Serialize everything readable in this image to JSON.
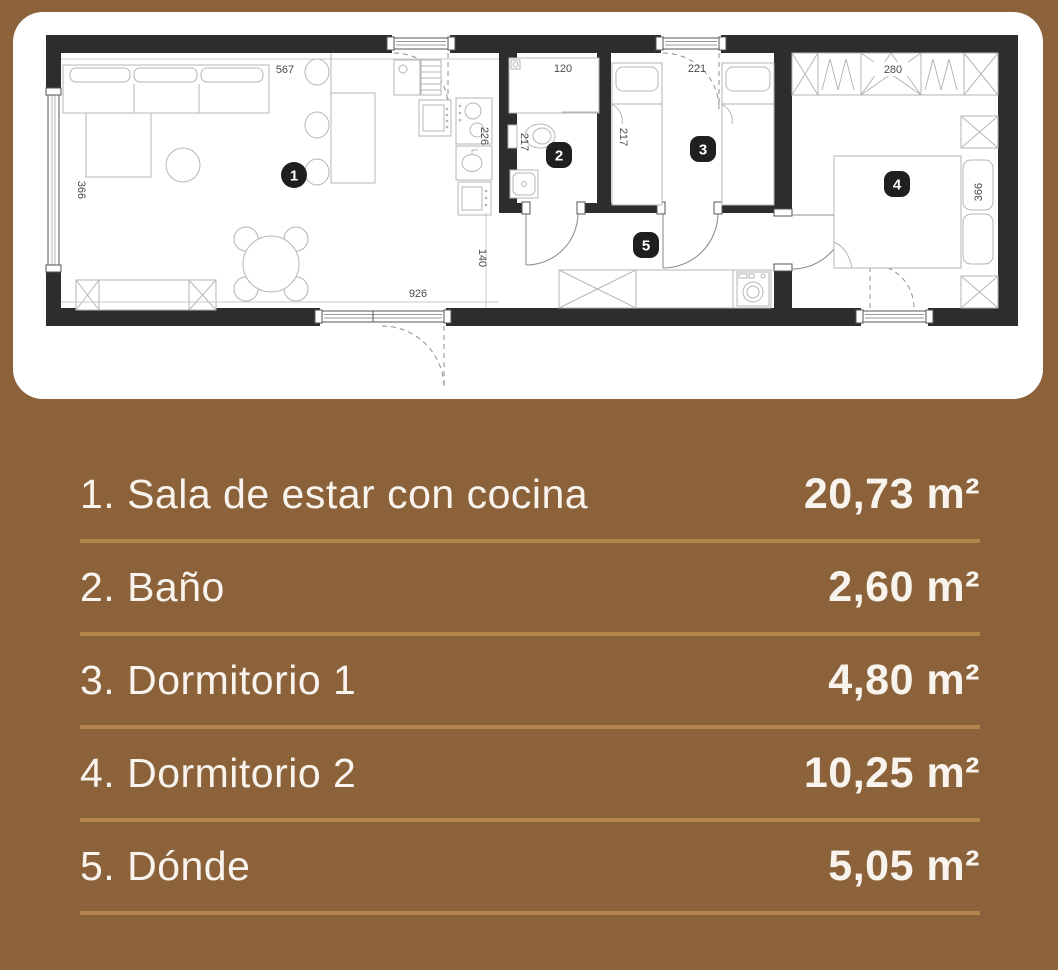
{
  "colors": {
    "background": "#8b6239",
    "card_bg": "#ffffff",
    "separator": "#b5854e",
    "legend_text": "#f8f3ed",
    "wall": "#2d2d2d"
  },
  "floorplan": {
    "dims": {
      "living_top": "567",
      "living_left": "366",
      "kitchen_side": "226",
      "bath_top": "120",
      "bath_side": "217",
      "room3_top": "221",
      "room3_side": "217",
      "room4_top": "280",
      "room4_side": "366",
      "bottom_width": "926",
      "hall_width": "140"
    },
    "badges": {
      "living": "1",
      "bath": "2",
      "room3": "3",
      "room4": "4",
      "hall": "5"
    }
  },
  "legend": {
    "rows": [
      {
        "label": "1. Sala de estar con cocina",
        "area": "20,73 m²"
      },
      {
        "label": "2. Baño",
        "area": "2,60 m²"
      },
      {
        "label": "3. Dormitorio 1",
        "area": "4,80 m²"
      },
      {
        "label": "4. Dormitorio 2",
        "area": "10,25 m²"
      },
      {
        "label": "5. Dónde",
        "area": "5,05 m²"
      }
    ]
  }
}
